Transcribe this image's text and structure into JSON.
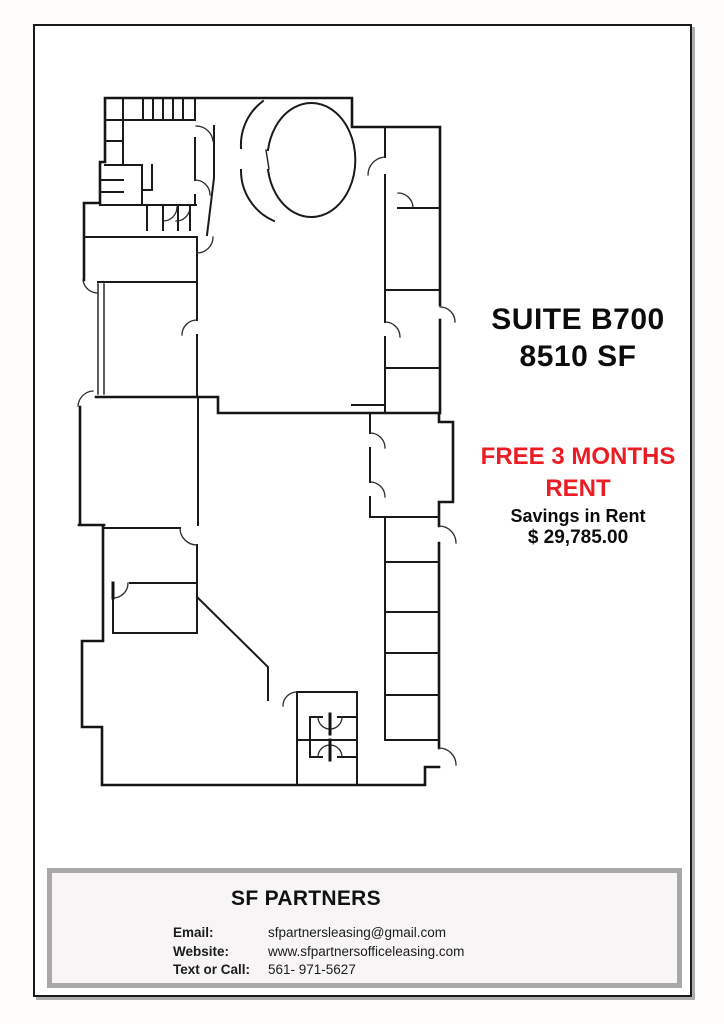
{
  "colors": {
    "accent_red": "#ec1c24",
    "wall_black": "#1a1a1a",
    "footer_border_gray": "#a9a7a8",
    "footer_bg": "#f7f5f6"
  },
  "listing": {
    "suite_line1": "SUITE B700",
    "suite_line2": "8510 SF",
    "promo_line1": "FREE 3 MONTHS",
    "promo_line2": "RENT",
    "savings_label": "Savings in Rent",
    "savings_amount": "$ 29,785.00"
  },
  "floor_plan": {
    "name": "suite-b700-floor-plan"
  },
  "footer": {
    "company": "SF PARTNERS",
    "contacts": [
      {
        "label": "Email:",
        "value": "sfpartnersleasing@gmail.com"
      },
      {
        "label": "Website:",
        "value": "www.sfpartnersofficeleasing.com"
      },
      {
        "label": "Text or Call:",
        "value": "561- 971-5627"
      }
    ]
  }
}
